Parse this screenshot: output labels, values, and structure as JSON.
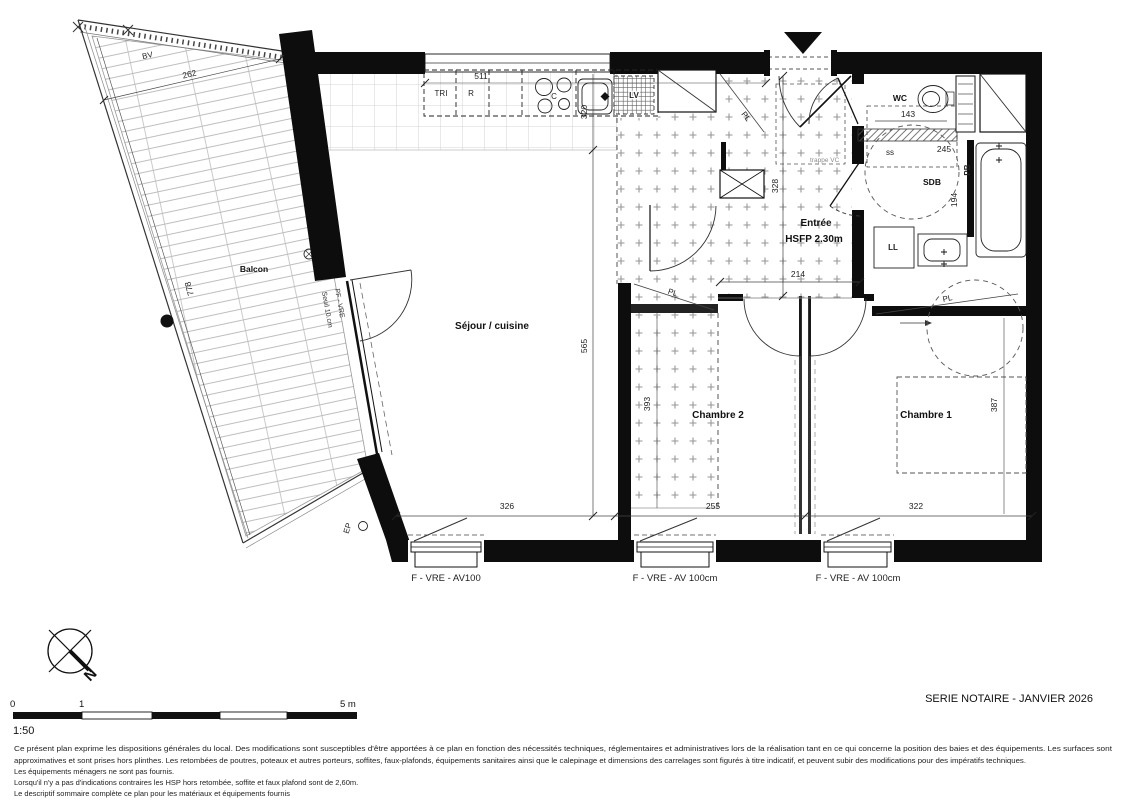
{
  "plan": {
    "rooms": {
      "balcon": "Balcon",
      "sejour": "Séjour / cuisine",
      "chambre2": "Chambre 2",
      "chambre1": "Chambre 1",
      "entree": "Entrée",
      "entree_hsfp": "HSFP 2.30m",
      "wc": "WC",
      "sdb": "SDB"
    },
    "fixtures": {
      "bv": "BV",
      "tri": "TRI",
      "fridge": "R",
      "hob": "C",
      "dishwasher": "LV",
      "washer": "LL",
      "bath": "PB",
      "towel": "ss",
      "downpipe": "EP",
      "closet_kitchen": "PL",
      "closet_corridor": "PL",
      "closet_chambre1": "PL",
      "hatch": "trappe VC"
    },
    "dims": {
      "balcony_width": "262",
      "balcony_length": "778",
      "kitchen_run": "511",
      "kitchen_depth": "320",
      "entry_height": "328",
      "entry_width": "214",
      "wc_width": "143",
      "sdb_width": "245",
      "sdb_depth": "194",
      "sejour_depth": "565",
      "corridor_depth": "393",
      "sejour_width": "326",
      "chambre2_width": "255",
      "chambre1_width": "322",
      "chambre1_depth": "387"
    },
    "windows": {
      "w1": "F - VRE - AV100",
      "w2": "F - VRE - AV 100cm",
      "w3": "F - VRE - AV 100cm"
    },
    "balcony_door": {
      "line1": "Seuil 10.cm",
      "line2": "PF - VRE"
    }
  },
  "footer": {
    "series": "SERIE NOTAIRE - JANVIER 2026",
    "scale_label": "1:50",
    "scale_ticks": {
      "zero": "0",
      "one": "1",
      "five": "5 m"
    },
    "north": "N",
    "notes": {
      "l1": "Ce présent plan exprime les dispositions générales du local. Des modifications sont susceptibles d'être apportées à ce plan en fonction des nécessités techniques, réglementaires et administratives lors de la réalisation tant en ce qui concerne la position des baies et des équipements. Les surfaces sont",
      "l2": "approximatives et sont prises hors plinthes. Les retombées de poutres, poteaux et autres porteurs, soffites, faux-plafonds, équipements sanitaires ainsi que le calepinage et dimensions des carrelages sont figurés à titre indicatif, et peuvent subir des modifications pour des impératifs techniques.",
      "l3": "Les équipements ménagers ne sont pas fournis.",
      "l4": "Lorsqu'il n'y a pas d'indications contraires les HSP hors retombée, soffite et faux plafond sont de 2,60m.",
      "l5": "Le descriptif sommaire complète ce plan pour les matériaux et équipements fournis"
    }
  }
}
